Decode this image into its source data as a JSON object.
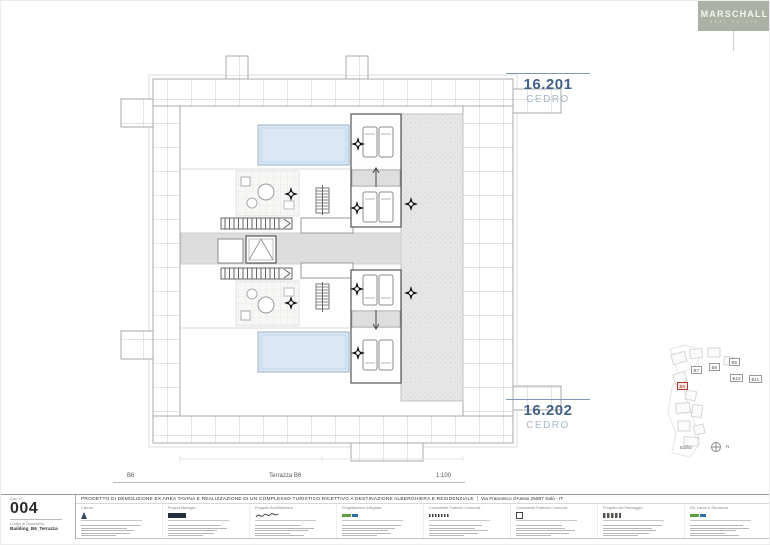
{
  "brand": {
    "name": "MARSCHALL",
    "tagline": "REAL ESTATE"
  },
  "units": [
    {
      "number": "16.201",
      "name": "CEDRO"
    },
    {
      "number": "16.202",
      "name": "CEDRO"
    }
  ],
  "scalebar": {
    "left": "B6",
    "center": "Terrazza B6",
    "right": "1:100"
  },
  "keyplan": {
    "buildings": [
      "B7",
      "B8",
      "B5",
      "B10",
      "B11"
    ],
    "highlighted": "B6",
    "caption": "Edifici",
    "north_label": "N"
  },
  "titleblock": {
    "doc_label": "Doc. n°",
    "doc_number": "004",
    "code_label": "Codice di Documento",
    "code_value": "Building_B6_Terrazza",
    "project_title": "PROGETTO DI DEMOLIZIONE  EX AREA TAVINA E REALIZZAZIONE  DI UN COMPLESSO TURISTICO RICETTIVO A DESTINAZIONE ALBERGHIERA E RESIDENZIALE",
    "separator": "|",
    "project_address": "Via Francesco d'Assisi 25087 Salò - IT",
    "columns": [
      {
        "header": "Cliente"
      },
      {
        "header": "Project Manager"
      },
      {
        "header": "Progetto Architettonico"
      },
      {
        "header": "Progettazione integrata"
      },
      {
        "header": "Consulente Pratiche Comunali"
      },
      {
        "header": "Consulente Pratiche Comunali"
      },
      {
        "header": "Progetto del Paesaggio"
      },
      {
        "header": "Dir. Lavori e Sicurezza"
      }
    ]
  },
  "colors": {
    "accent_blue": "#44618a",
    "accent_blue_light": "#a9b7c9",
    "leader_line": "#7d98b4",
    "logo_background": "#a9b2a5",
    "highlight_red": "#b03a2e",
    "pool": "#d9e8f4"
  }
}
